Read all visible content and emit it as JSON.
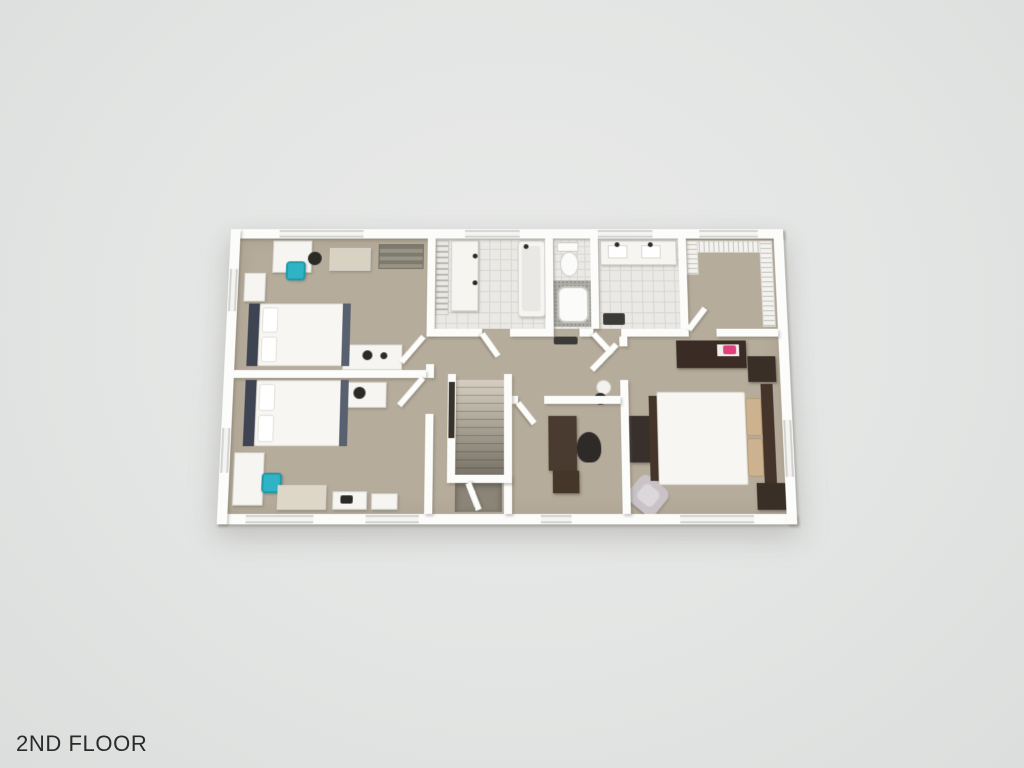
{
  "floor_label": "2ND FLOOR",
  "palette": {
    "bg": "#e3e5e4",
    "bgLight": "#e9eae9",
    "bgDark": "#dcdedd",
    "carpet": "#b6ac9b",
    "wall": "#fcfcfb",
    "tile": "#ebe9e6",
    "tileLine": "#d8d6d1",
    "navy": "#3e4452",
    "walnut": "#44342a",
    "darkFurn": "#3a2f27",
    "bedWhite": "#f7f6f3",
    "pillowTan": "#cdb28f",
    "teal": "#2eb4c5",
    "pink": "#e0417d",
    "armchair": "#c9c3c7",
    "stairTread": "#d6cfc1",
    "stairRail": "#38322b",
    "stairVoid": "#8b8477",
    "matDark": "#3c3a36",
    "text": "#2a2a2a"
  },
  "scene": {
    "type": "3d-rendered-floor-plan",
    "rooms": [
      {
        "name": "bedroom-top-left",
        "contents": [
          "white desk",
          "teal desk chair",
          "dark stool",
          "white nightstand",
          "beige cabinet",
          "rustic slat shelf",
          "bed with dark blue headboard",
          "white console with black decor"
        ]
      },
      {
        "name": "bedroom-bottom-left",
        "contents": [
          "bed with dark blue headboard",
          "white dresser with dark knob",
          "white desk",
          "teal desk chair",
          "beige storage unit",
          "white side tables"
        ]
      },
      {
        "name": "hall-bathroom",
        "contents": [
          "linen shelving",
          "vanity with two sinks",
          "walk-in shower"
        ]
      },
      {
        "name": "toilet-and-tub-room",
        "contents": [
          "toilet",
          "bathtub with gray speckled deck",
          "dark door mat"
        ]
      },
      {
        "name": "master-bathroom",
        "contents": [
          "double-sink vanity",
          "tiled floor",
          "dark bath mat"
        ]
      },
      {
        "name": "walk-in-closet",
        "contents": [
          "white wire shelving on three walls"
        ]
      },
      {
        "name": "hallway-and-stairs",
        "contents": [
          "staircase descending",
          "dark handrail",
          "potted plant"
        ]
      },
      {
        "name": "office",
        "contents": [
          "dark wood desk",
          "black office chair",
          "dark desk return"
        ]
      },
      {
        "name": "master-bedroom",
        "contents": [
          "bed with white duvet and tan pillows",
          "dark brown headboard",
          "two dark nightstands",
          "dark dresser with pink decor on white runner",
          "tall dark wardrobe",
          "light gray armchair"
        ]
      }
    ]
  }
}
